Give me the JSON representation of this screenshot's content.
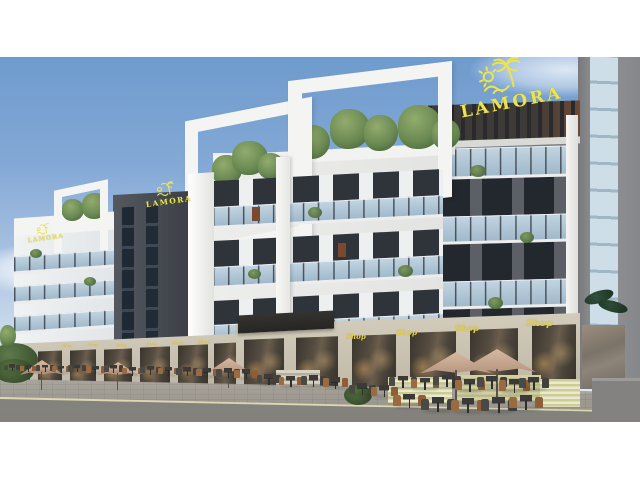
{
  "meta": {
    "type": "architectural-exterior-render",
    "project": "LAMORA",
    "description": "Street-level rendering of the LAMORA mixed-use building: white rooftop frames, rooftop trees, glass balconies, dark feature tower, ground-floor shops with yellow Shop signs, outdoor cafe seating with tan umbrellas"
  },
  "branding": {
    "logo_text_main": "LAMORA",
    "logo_text_tower": "LAMORA",
    "logo_text_parapet": "LAMORA",
    "logo_color": "#ECE44C",
    "logo_icon": "palm-tree-sun-waves"
  },
  "storefronts": {
    "right_signs": [
      "Shop",
      "Shop",
      "Shop",
      "Shop"
    ],
    "left_signs": [
      "Shop",
      "Shop",
      "Shop",
      "Shop",
      "Shop",
      "Shop"
    ],
    "sign_color": "#E4D04B"
  },
  "environment": {
    "sky_top": "#6E9BCD",
    "sky_horizon": "#E9F0F7",
    "road": "#8B8984",
    "pavement": "#A5A098",
    "curb_line": "#DDD8B2",
    "umbrella": "#C2A28C",
    "cafe_chair_wood": "#9A6A42",
    "cafe_metal": "#4B4945",
    "greenery": "#6A8A52"
  },
  "architecture": {
    "white_frames": "#F4F4F2",
    "dark_tower": "#43474E",
    "right_facade": "#6E7278",
    "glass": "#BDD2E2",
    "stone_base": "#CDC5B4",
    "stripe_planter": "#CCCD90"
  }
}
